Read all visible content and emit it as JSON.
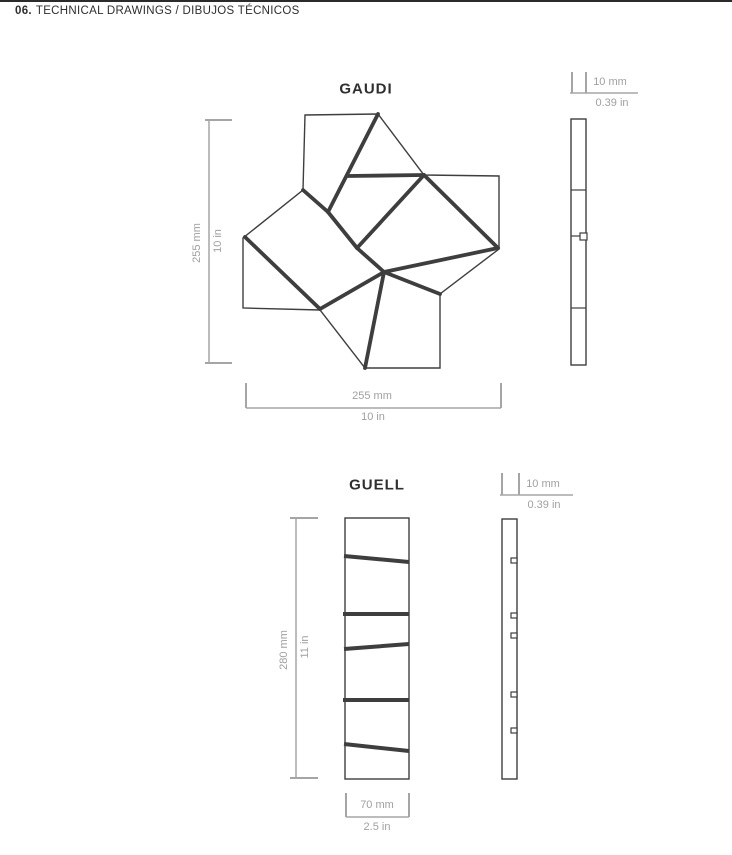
{
  "header": {
    "number": "06.",
    "title": "TECHNICAL DRAWINGS / DIBUJOS TÉCNICOS"
  },
  "gaudi": {
    "title": "GAUDI",
    "height_mm": "255 mm",
    "height_in": "10 in",
    "width_mm": "255 mm",
    "width_in": "10 in",
    "thickness_mm": "10 mm",
    "thickness_in": "0.39 in"
  },
  "guell": {
    "title": "GUELL",
    "height_mm": "280 mm",
    "height_in": "11 in",
    "width_mm": "70 mm",
    "width_in": "2.5 in",
    "thickness_mm": "10 mm",
    "thickness_in": "0.39 in"
  },
  "colors": {
    "drawing_line": "#3e3e3e",
    "dimension": "#a5a5a5",
    "header_text": "#2e2e2e"
  },
  "geometry": {
    "gaudi_front": {
      "outline": [
        [
          305,
          115
        ],
        [
          378,
          114
        ],
        [
          424,
          175
        ],
        [
          499,
          176
        ],
        [
          499,
          249
        ],
        [
          440,
          294
        ],
        [
          440,
          368
        ],
        [
          365,
          368
        ],
        [
          320,
          310
        ],
        [
          243,
          308
        ],
        [
          243,
          238
        ],
        [
          303,
          190
        ]
      ],
      "thick_segments": [
        [
          [
            378,
            114
          ],
          [
            328,
            212
          ]
        ],
        [
          [
            303,
            190
          ],
          [
            328,
            212
          ]
        ],
        [
          [
            328,
            212
          ],
          [
            357,
            248
          ]
        ],
        [
          [
            424,
            175
          ],
          [
            357,
            248
          ]
        ],
        [
          [
            348,
            176
          ],
          [
            424,
            175
          ]
        ],
        [
          [
            424,
            175
          ],
          [
            498,
            248
          ]
        ],
        [
          [
            498,
            248
          ],
          [
            384,
            272
          ]
        ],
        [
          [
            357,
            248
          ],
          [
            384,
            272
          ]
        ],
        [
          [
            384,
            272
          ],
          [
            440,
            294
          ]
        ],
        [
          [
            384,
            272
          ],
          [
            365,
            368
          ]
        ],
        [
          [
            384,
            272
          ],
          [
            320,
            309
          ]
        ],
        [
          [
            245,
            237
          ],
          [
            320,
            309
          ]
        ]
      ]
    },
    "gaudi_side": {
      "rect": [
        571,
        119,
        15,
        246
      ],
      "lines": [
        [
          571,
          190,
          586,
          190
        ],
        [
          571,
          236,
          586,
          236
        ],
        [
          571,
          308,
          586,
          308
        ]
      ],
      "tab": [
        580,
        233,
        7,
        7
      ]
    },
    "gaudi_dims": {
      "v_line": [
        209,
        120,
        209,
        363
      ],
      "v_ticks": [
        [
          205,
          120,
          232,
          120
        ],
        [
          205,
          363,
          232,
          363
        ]
      ],
      "h_line": [
        246,
        408,
        501,
        408
      ],
      "h_ticks": [
        [
          246,
          383,
          246,
          408
        ],
        [
          501,
          383,
          501,
          408
        ]
      ],
      "t_line": [
        570,
        93,
        638,
        93
      ],
      "t_ticks": [
        [
          572,
          72,
          572,
          93
        ],
        [
          586,
          72,
          586,
          93
        ]
      ]
    },
    "guell_front": {
      "rect": [
        345,
        518,
        64,
        261
      ],
      "slats": [
        [
          [
            344,
            556
          ],
          [
            409,
            562
          ]
        ],
        [
          [
            343,
            614
          ],
          [
            409,
            614
          ]
        ],
        [
          [
            344,
            649
          ],
          [
            409,
            644
          ]
        ],
        [
          [
            343,
            700
          ],
          [
            409,
            700
          ]
        ],
        [
          [
            344,
            744
          ],
          [
            409,
            751
          ]
        ]
      ]
    },
    "guell_side": {
      "rect": [
        502,
        519,
        15,
        260
      ],
      "clips": [
        [
          511,
          558,
          6,
          5
        ],
        [
          511,
          613,
          6,
          5
        ],
        [
          511,
          633,
          6,
          5
        ],
        [
          511,
          692,
          6,
          5
        ],
        [
          511,
          728,
          6,
          5
        ]
      ]
    },
    "guell_dims": {
      "v_line": [
        296,
        518,
        296,
        778
      ],
      "v_ticks": [
        [
          290,
          518,
          318,
          518
        ],
        [
          290,
          778,
          318,
          778
        ]
      ],
      "h_line": [
        346,
        817,
        409,
        817
      ],
      "h_ticks": [
        [
          346,
          793,
          346,
          817
        ],
        [
          409,
          793,
          409,
          817
        ]
      ],
      "t_line": [
        500,
        495,
        573,
        495
      ],
      "t_ticks": [
        [
          502,
          473,
          502,
          495
        ],
        [
          519,
          473,
          519,
          495
        ]
      ]
    }
  }
}
